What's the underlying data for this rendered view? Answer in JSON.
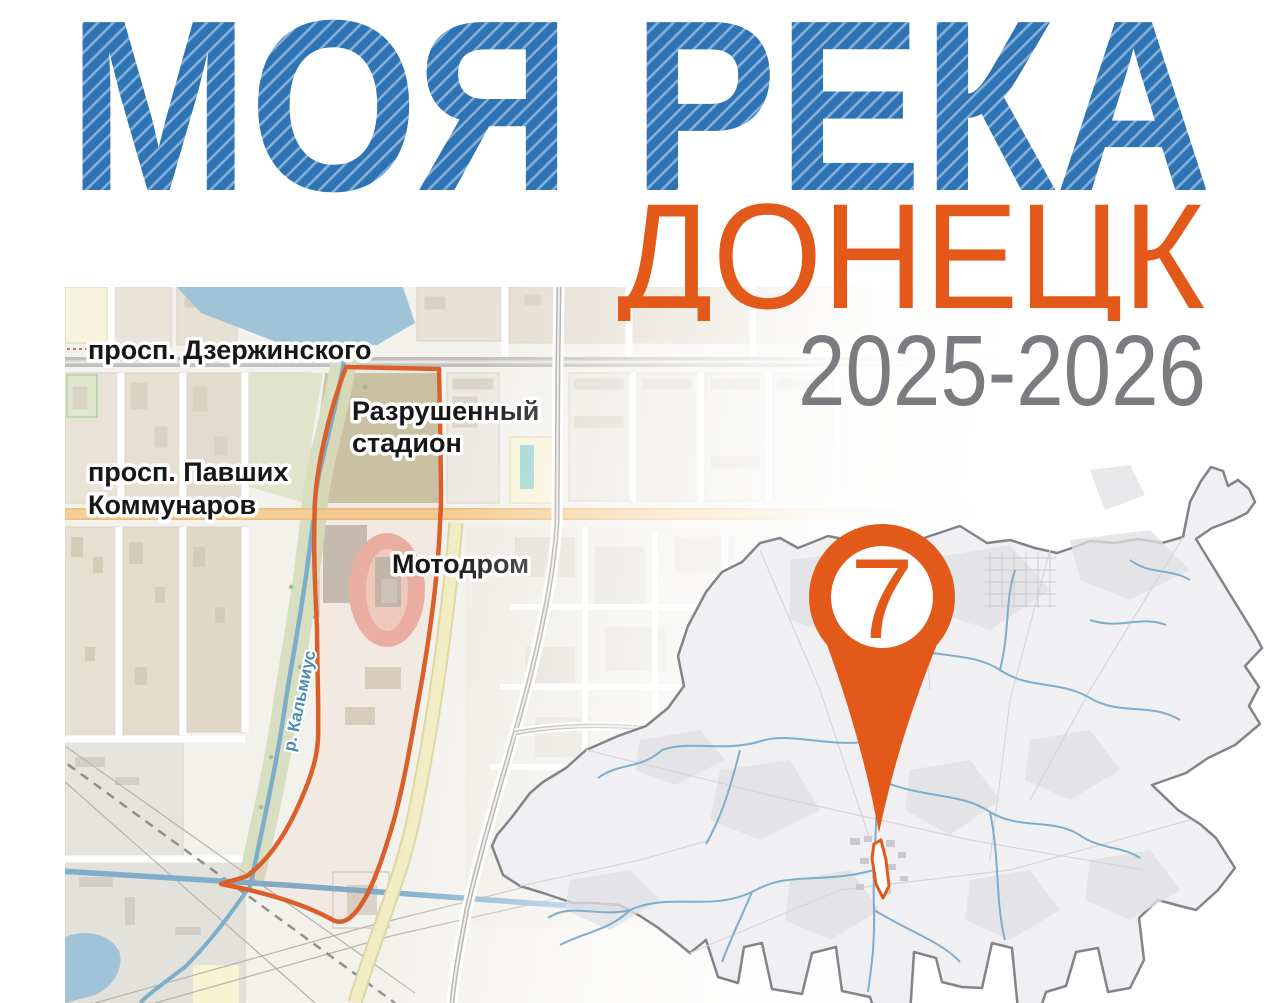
{
  "poster": {
    "title": "МОЯ РЕКА",
    "subtitle": "ДОНЕЦК",
    "period": "2025-2026",
    "colors": {
      "title_blue": "#2E73B4",
      "title_stripe": "#84AFD8",
      "accent_orange": "#E2591A",
      "period_gray": "#7C7C80",
      "route_outline_orange": "#D95F2B",
      "water_blue": "#9FC3D7",
      "river_blue": "#7FAECB",
      "region_boundary_gray": "#83838A"
    }
  },
  "city_map": {
    "labels": {
      "avenue_top": "просп. Дзержинского",
      "stadium_line1": "Разрушенный",
      "stadium_line2": "стадион",
      "avenue_mid_line1": "просп. Павших",
      "avenue_mid_line2": "Коммунаров",
      "motodrome": "Мотодром",
      "river": "р. Кальмиус"
    }
  },
  "overview_map": {
    "pin": {
      "number": "7"
    }
  }
}
